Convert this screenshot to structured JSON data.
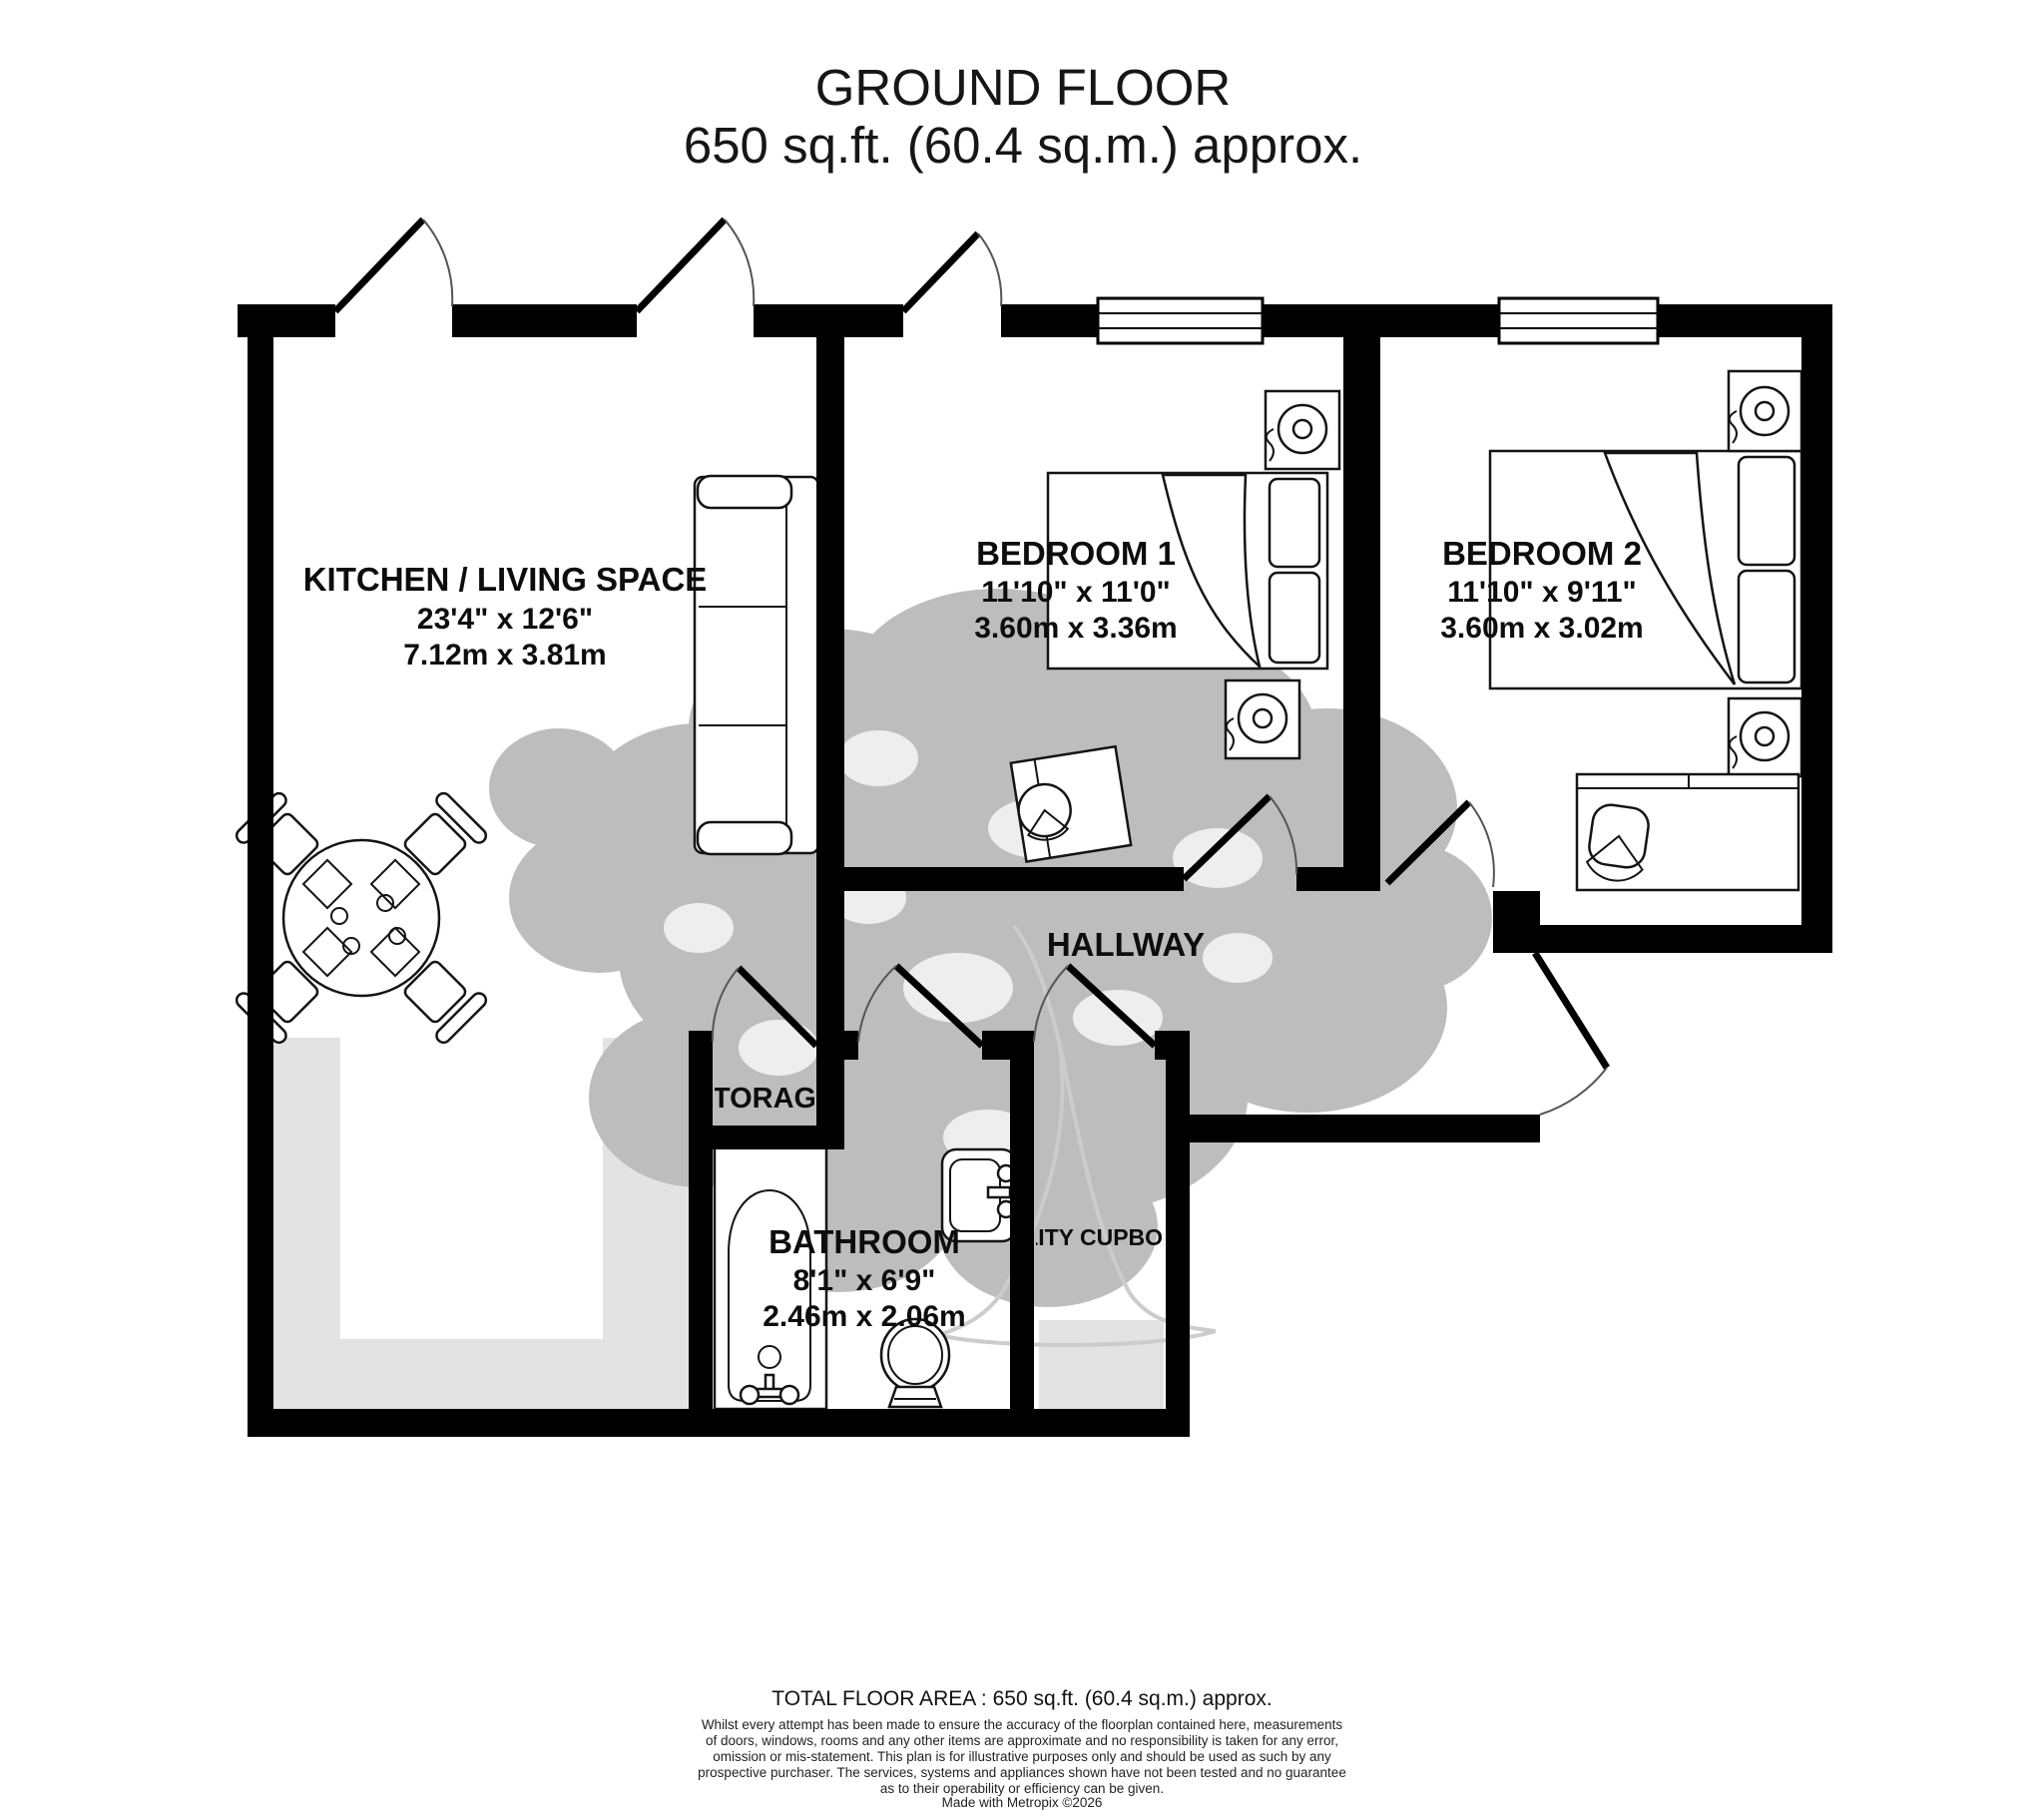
{
  "title": {
    "line1": "GROUND FLOOR",
    "line2": "650 sq.ft. (60.4 sq.m.) approx."
  },
  "rooms": {
    "kitchen": {
      "name": "KITCHEN / LIVING SPACE",
      "imperial": "23'4\"  x 12'6\"",
      "metric": "7.12m  x 3.81m"
    },
    "bedroom1": {
      "name": "BEDROOM 1",
      "imperial": "11'10\"  x 11'0\"",
      "metric": "3.60m  x 3.36m"
    },
    "bedroom2": {
      "name": "BEDROOM 2",
      "imperial": "11'10\"  x 9'11\"",
      "metric": "3.60m  x 3.02m"
    },
    "bathroom": {
      "name": "BATHROOM",
      "imperial": "8'1\"  x 6'9\"",
      "metric": "2.46m  x 2.06m"
    },
    "hallway": {
      "name": "HALLWAY"
    },
    "storage": {
      "name": "STORAGE"
    },
    "utility": {
      "name": "UTILITY CUPBOARD"
    }
  },
  "footer": {
    "total": "TOTAL FLOOR AREA : 650 sq.ft. (60.4 sq.m.) approx.",
    "disclaimer_lines": [
      "Whilst every attempt has been made to ensure the accuracy of the floorplan contained here, measurements",
      "of doors, windows, rooms and any other items are approximate and no responsibility is taken for any error,",
      "omission or mis-statement. This plan is for illustrative purposes only and should be used as such by any",
      "prospective purchaser. The services, systems and appliances shown have not been tested and no guarantee",
      "as to their operability or efficiency can be given."
    ],
    "credit": "Made with Metropix ©2026"
  },
  "colors": {
    "wall": "#000000",
    "floor_shade": "#e3e3e3",
    "tree": "#bdbdbd",
    "text": "#0d0d0d"
  }
}
